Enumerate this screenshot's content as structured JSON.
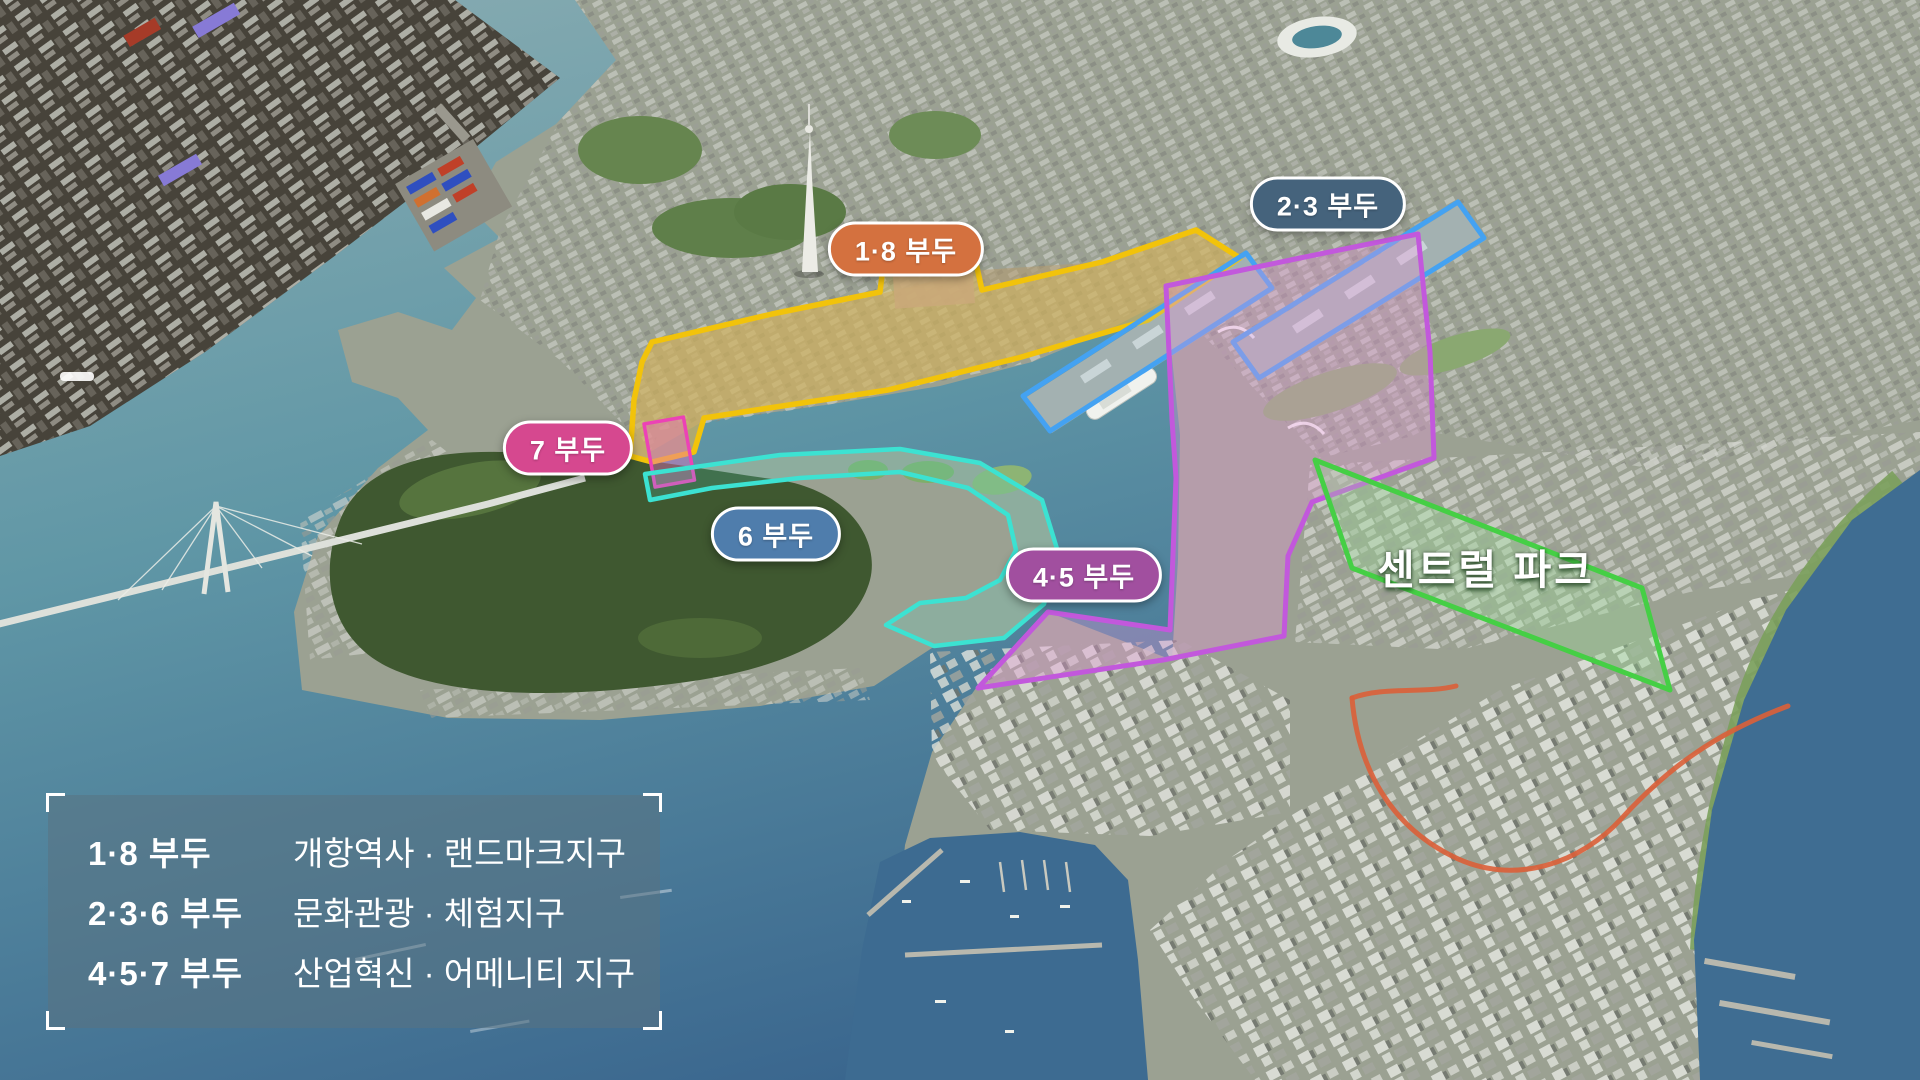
{
  "map": {
    "labels": {
      "pier18": {
        "text": "1·8 부두",
        "bg": "#d4713f"
      },
      "pier23": {
        "text": "2·3 부두",
        "bg": "#45637c"
      },
      "pier7": {
        "text": "7 부두",
        "bg": "#d6488f"
      },
      "pier6": {
        "text": "6 부두",
        "bg": "#4f7dac"
      },
      "pier45": {
        "text": "4·5 부두",
        "bg": "#a14f9f"
      },
      "central_park": {
        "text": "센트럴 파크"
      }
    },
    "outline_colors": {
      "pier18": "#f2c30a",
      "pier23": "#44a2f2",
      "pier7": "#ec42b6",
      "pier6": "#3ce2d2",
      "pier45": "#c258dc",
      "central_park": "#45cf45",
      "coastal_road": "#dc5f38"
    }
  },
  "legend": {
    "rows": [
      {
        "term": "1·8 부두",
        "desc": "개항역사 · 랜드마크지구"
      },
      {
        "term": "2·3·6 부두",
        "desc": "문화관광 · 체험지구"
      },
      {
        "term": "4·5·7 부두",
        "desc": "산업혁신 · 어메니티 지구"
      }
    ]
  }
}
